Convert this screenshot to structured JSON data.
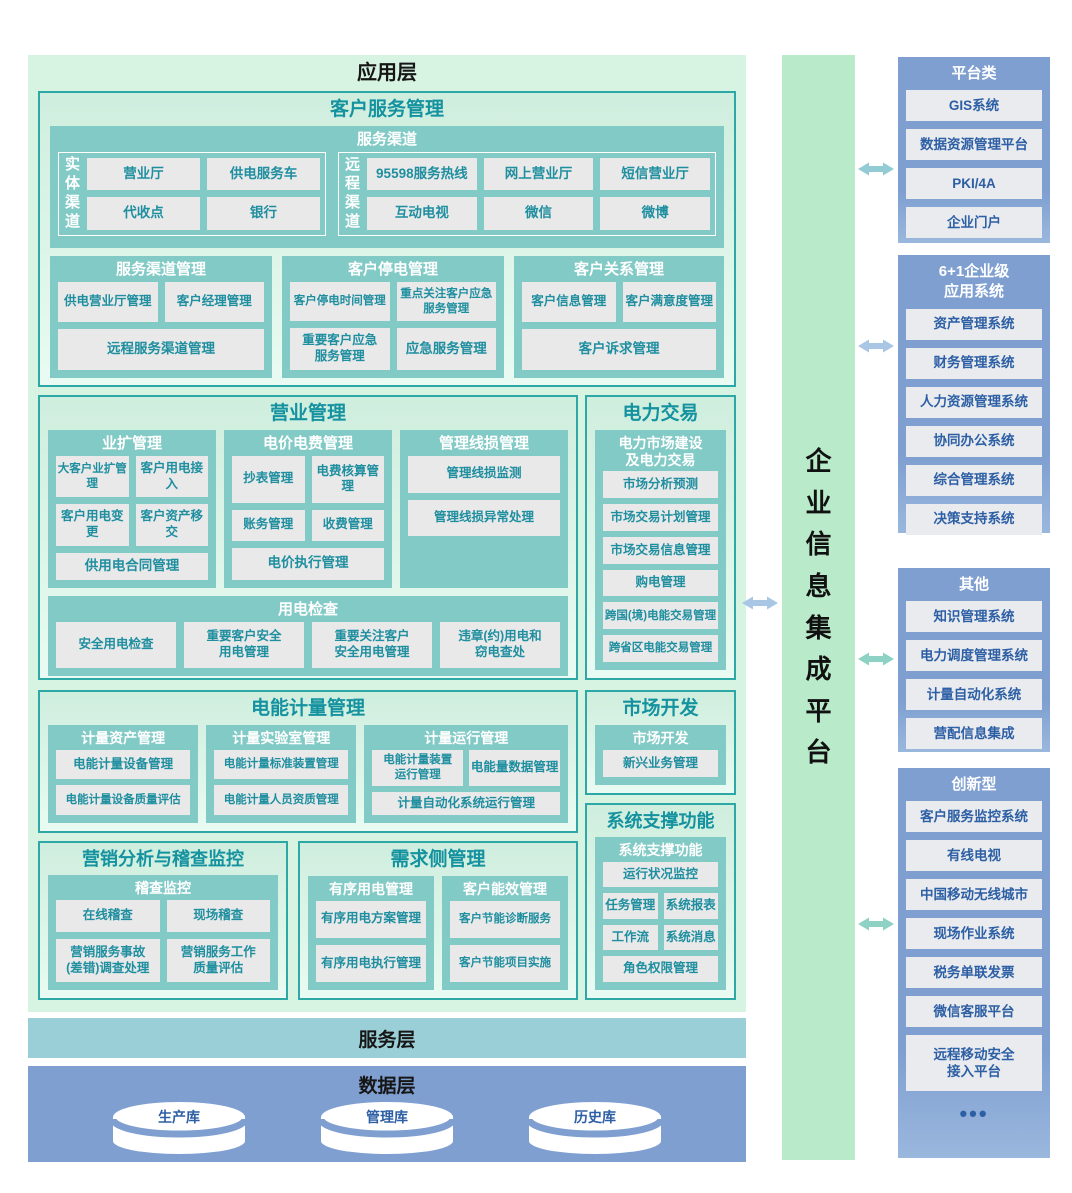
{
  "colors": {
    "section_border": "#2ea7a7",
    "section_title": "#15929f",
    "mint_panel": "#d7f3e2",
    "teal_box": "#82cac6",
    "item_bg": "#e9e9e9",
    "item_text": "#1f8fa0",
    "service_layer_bg": "#9bcfd7",
    "steel_blue": "#7e9fd0",
    "right_item_text": "#2d5fa5",
    "platform_green": "#b9eac9",
    "arrow_blue": "#a9c6e4",
    "arrow_teal": "#8ed2c6",
    "arrow_teal_blue": "#92cbd4"
  },
  "app_layer": {
    "title": "应用层"
  },
  "customer_service": {
    "title": "客户服务管理",
    "service_channels": {
      "title": "服务渠道",
      "physical": {
        "label": "实体渠道",
        "items": [
          "营业厅",
          "供电服务车",
          "代收点",
          "银行"
        ]
      },
      "remote": {
        "label": "远程渠道",
        "items": [
          "95598服务热线",
          "网上营业厅",
          "短信营业厅",
          "互动电视",
          "微信",
          "微博"
        ]
      }
    },
    "channel_mgmt": {
      "title": "服务渠道管理",
      "items": [
        "供电营业厅管理",
        "客户经理管理",
        "远程服务渠道管理"
      ]
    },
    "outage_mgmt": {
      "title": "客户停电管理",
      "items": [
        "客户停电时间管理",
        "重点关注客户应急\n服务管理",
        "重要客户应急\n服务管理",
        "应急服务管理"
      ]
    },
    "crm": {
      "title": "客户关系管理",
      "items": [
        "客户信息管理",
        "客户满意度管理",
        "客户诉求管理"
      ]
    }
  },
  "business_mgmt": {
    "title": "营业管理",
    "expansion": {
      "title": "业扩管理",
      "items": [
        "大客户业扩管理",
        "客户用电接入",
        "客户用电变更",
        "客户资产移交",
        "供用电合同管理"
      ]
    },
    "pricing": {
      "title": "电价电费管理",
      "items": [
        "抄表管理",
        "电费核算管理",
        "账务管理",
        "收费管理",
        "电价执行管理"
      ]
    },
    "line_loss": {
      "title": "管理线损管理",
      "items": [
        "管理线损监测",
        "管理线损异常处理"
      ]
    },
    "inspection": {
      "title": "用电检查",
      "items": [
        "安全用电检查",
        "重要客户安全\n用电管理",
        "重要关注客户\n安全用电管理",
        "违章(约)用电和\n窃电查处"
      ]
    }
  },
  "power_trading": {
    "title": "电力交易",
    "sub": {
      "title": "电力市场建设\n及电力交易",
      "items": [
        "市场分析预测",
        "市场交易计划管理",
        "市场交易信息管理",
        "购电管理",
        "跨国(境)电能交易管理",
        "跨省区电能交易管理"
      ]
    }
  },
  "metering": {
    "title": "电能计量管理",
    "asset": {
      "title": "计量资产管理",
      "items": [
        "电能计量设备管理",
        "电能计量设备质量评估"
      ]
    },
    "lab": {
      "title": "计量实验室管理",
      "items": [
        "电能计量标准装置管理",
        "电能计量人员资质管理"
      ]
    },
    "operation": {
      "title": "计量运行管理",
      "items": [
        "电能计量装置\n运行管理",
        "电能量数据管理",
        "计量自动化系统运行管理"
      ]
    }
  },
  "market_dev": {
    "title": "市场开发",
    "sub": {
      "title": "市场开发",
      "items": [
        "新兴业务管理"
      ]
    }
  },
  "marketing_audit": {
    "title": "营销分析与稽查监控",
    "sub": {
      "title": "稽查监控",
      "items": [
        "在线稽查",
        "现场稽查",
        "营销服务事故\n(差错)调查处理",
        "营销服务工作\n质量评估"
      ]
    }
  },
  "demand_side": {
    "title": "需求侧管理",
    "orderly": {
      "title": "有序用电管理",
      "items": [
        "有序用电方案管理",
        "有序用电执行管理"
      ]
    },
    "efficiency": {
      "title": "客户能效管理",
      "items": [
        "客户节能诊断服务",
        "客户节能项目实施"
      ]
    }
  },
  "system_support": {
    "title": "系统支撑功能",
    "sub": {
      "title": "系统支撑功能",
      "items": [
        "运行状况监控",
        "任务管理",
        "系统报表",
        "工作流",
        "系统消息",
        "角色权限管理"
      ]
    }
  },
  "service_layer": {
    "title": "服务层"
  },
  "data_layer": {
    "title": "数据层",
    "databases": [
      "生产库",
      "管理库",
      "历史库"
    ]
  },
  "platform": {
    "title": "企业信息集成平台"
  },
  "right_panel": {
    "groups": [
      {
        "title": "平台类",
        "items": [
          "GIS系统",
          "数据资源管理平台",
          "PKI/4A",
          "企业门户"
        ]
      },
      {
        "title": "6+1企业级\n应用系统",
        "items": [
          "资产管理系统",
          "财务管理系统",
          "人力资源管理系统",
          "协同办公系统",
          "综合管理系统",
          "决策支持系统"
        ]
      },
      {
        "title": "其他",
        "items": [
          "知识管理系统",
          "电力调度管理系统",
          "计量自动化系统",
          "营配信息集成"
        ]
      },
      {
        "title": "创新型",
        "items": [
          "客户服务监控系统",
          "有线电视",
          "中国移动无线城市",
          "现场作业系统",
          "税务单联发票",
          "微信客服平台",
          "远程移动安全\n接入平台"
        ],
        "more": "•••"
      }
    ]
  }
}
